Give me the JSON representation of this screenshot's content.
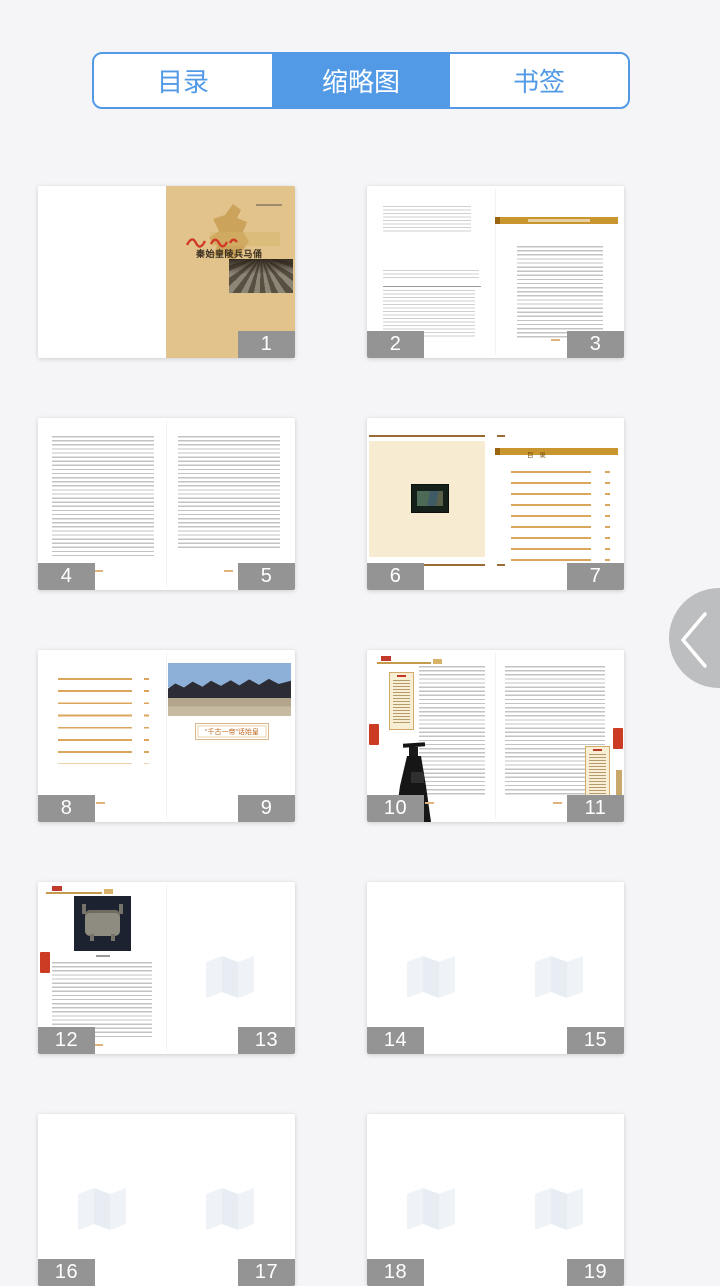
{
  "tab_bar": {
    "tabs": [
      {
        "label": "目录",
        "active": false
      },
      {
        "label": "缩略图",
        "active": true
      },
      {
        "label": "书签",
        "active": false
      }
    ]
  },
  "thumbnails": [
    {
      "type": "cover",
      "right_page": "1",
      "cover_title": "秦始皇陵兵马俑"
    },
    {
      "type": "spread",
      "left_page": "2",
      "right_page": "3"
    },
    {
      "type": "spread",
      "left_page": "4",
      "right_page": "5"
    },
    {
      "type": "spread",
      "left_page": "6",
      "right_page": "7",
      "toc_title": "目 录"
    },
    {
      "type": "spread",
      "left_page": "8",
      "right_page": "9",
      "caption": "“千古一帝”话始皇"
    },
    {
      "type": "spread",
      "left_page": "10",
      "right_page": "11"
    },
    {
      "type": "spread",
      "left_page": "12",
      "right_page": "13"
    },
    {
      "type": "blank",
      "left_page": "14",
      "right_page": "15"
    },
    {
      "type": "blank",
      "left_page": "16",
      "right_page": "17"
    },
    {
      "type": "blank",
      "left_page": "18",
      "right_page": "19"
    }
  ],
  "colors": {
    "accent": "#539ae6",
    "badge": "#949494",
    "gold": "#c8952f",
    "cover_tan": "#e2c38c",
    "cream": "#f7ecd2",
    "seal_red": "#cc3b24"
  },
  "side_handle": {
    "icon": "chevron-left"
  }
}
